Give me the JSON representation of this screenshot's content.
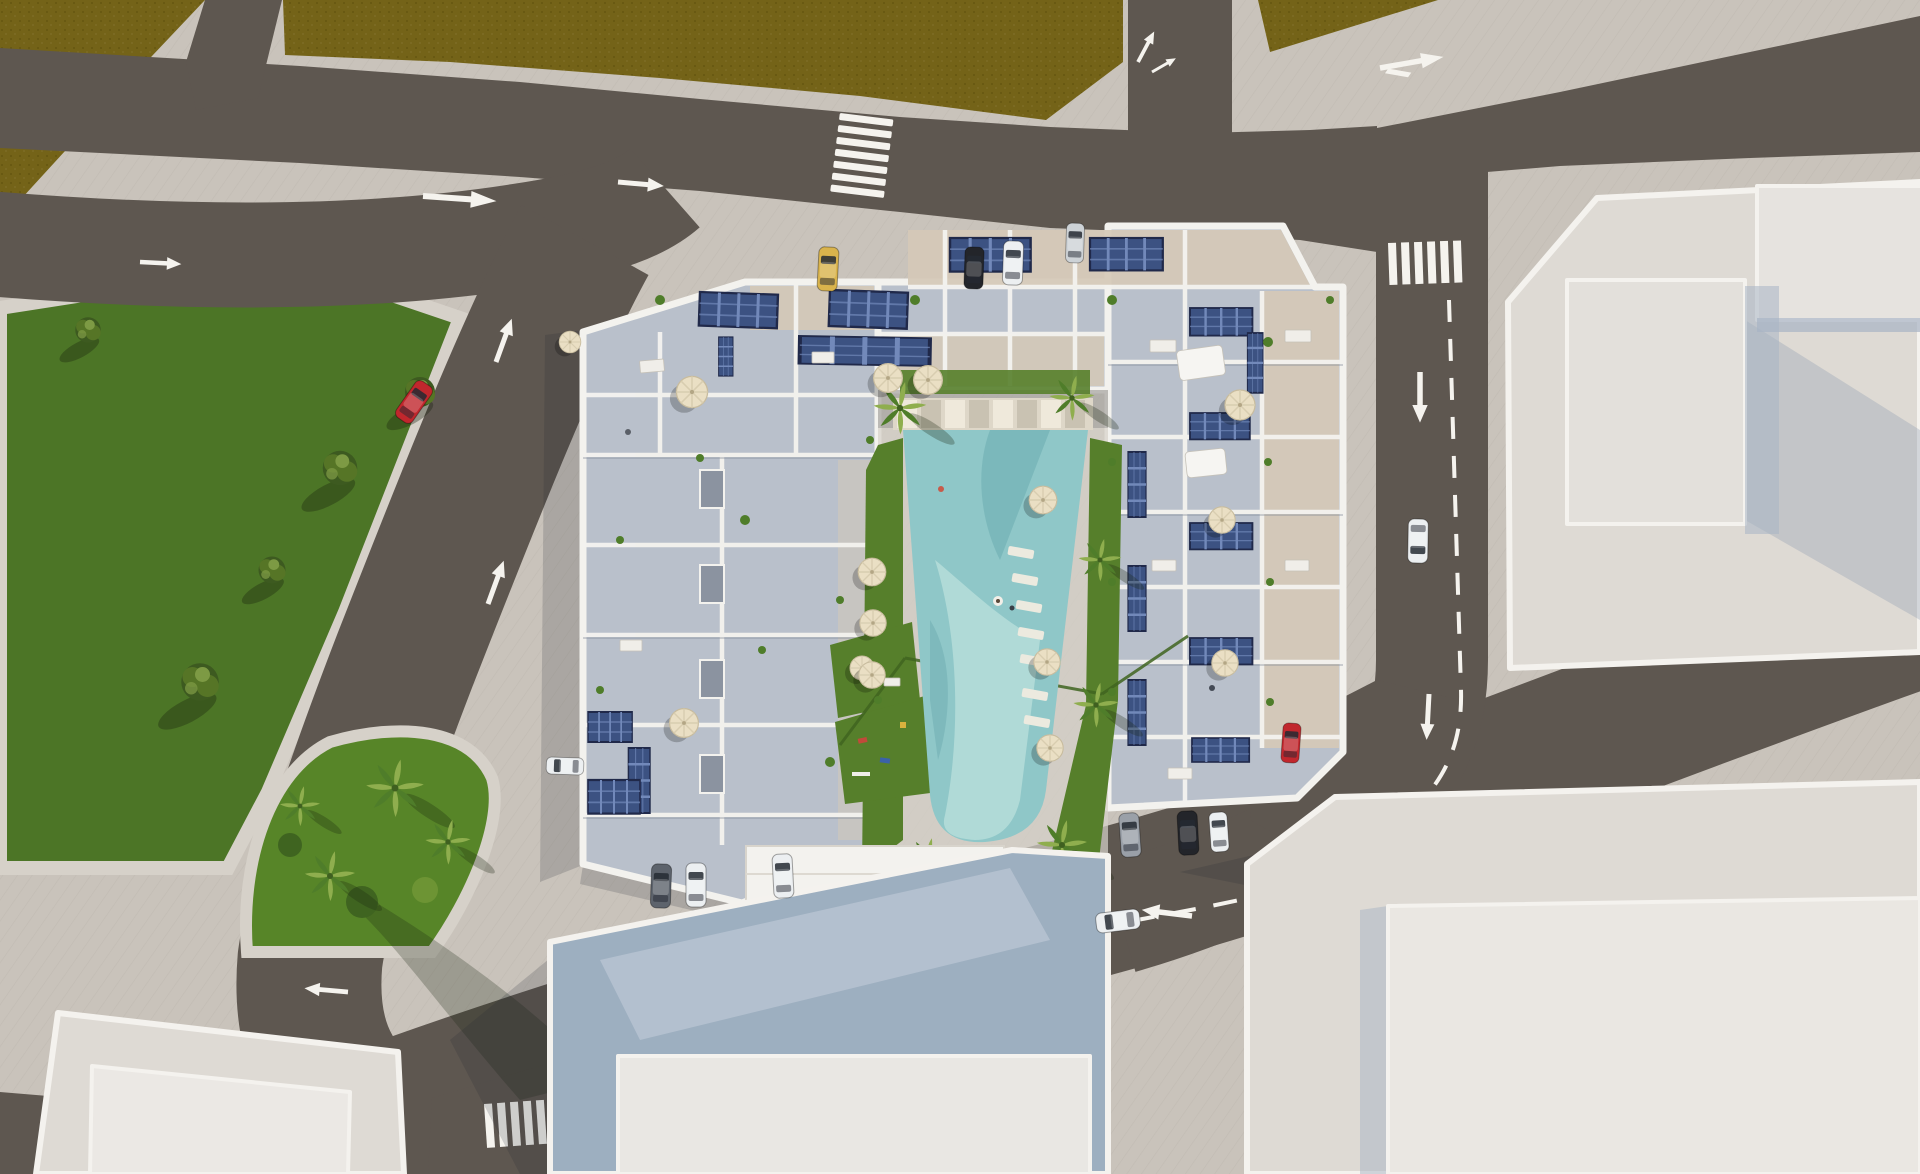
{
  "meta": {
    "title": "Aerial 3D architectural rendering",
    "description": "Top-down bird's-eye 3D render of a white residential apartment complex with rooftop solar panels and terraces around a central courtyard with a turquoise swimming pool, lawns and palm trees; surrounded by asphalt roads with white lane arrows, dashed lines and zebra crossings; olive farmland fields at top-left, a green park with trees on the left, a palm-planted traffic island at bottom-left, and large light-grey warehouse buildings on the right and bottom."
  },
  "palette": {
    "sidewalk": "#c9c3bb",
    "sidewalkLight": "#d6d1c9",
    "field": "#746318",
    "fieldDot": "#64550f",
    "road": "#5e5750",
    "marking": "#f5f3ee",
    "park": "#4c7526",
    "island": "#578528",
    "lawn": "#567f2b",
    "lawnDark": "#3f6420",
    "treeDark": "#3d5a20",
    "treeMid": "#567526",
    "treeLight": "#7d9a44",
    "palm": "#4f7d2a",
    "palmLight": "#8fae4e",
    "wall": "#f3f2ee",
    "floorCool": "#b9c0cb",
    "floorWarm": "#d5c9b7",
    "solar": "#3c5282",
    "solarLine": "#7289ba",
    "umbrella": "#eadfc4",
    "pool": "#8fc7c8",
    "poolLight": "#b8dedb",
    "poolDark": "#64a6ab",
    "coping": "#ded7c8",
    "warehouse": "#dedad4",
    "warehouseTrim": "#f4f2ee",
    "warehouseShade": "#a8b4c4",
    "roofCool": "#9dafc0",
    "carRed": "#c1272d",
    "carYellow": "#d9b34c",
    "carWhite": "#eceff1",
    "carBlack": "#23252a",
    "carGray": "#9aa0a8",
    "carSilver": "#cdd2d6"
  },
  "scene": {
    "environment": {
      "fields": 2,
      "park_trees": 5,
      "island_palms": 4,
      "courtyard_palms": 6,
      "lawns": 5
    },
    "complex": {
      "wings": 3,
      "solar_arrays": 16,
      "umbrellas": 15,
      "swimming_pool": 1,
      "pool_swimmers": 2,
      "pool_shape": "trapezoid, narrows toward south"
    },
    "warehouses": [
      {
        "position": "top-right",
        "raised_roof_sections": 2
      },
      {
        "position": "bottom-right",
        "raised_roof_sections": 1
      },
      {
        "position": "bottom-center",
        "roof": "blue-grey sloped"
      },
      {
        "position": "bottom-left",
        "raised_roof_sections": 1
      }
    ],
    "road_markings": {
      "zebra_crossings": 3,
      "lane_arrows": 12,
      "dashed_center_lines": 2
    },
    "cars": [
      {
        "color": "yellow",
        "area": "north parking row"
      },
      {
        "color": "black",
        "area": "north parking row"
      },
      {
        "color": "white",
        "area": "north parking row"
      },
      {
        "color": "silver",
        "area": "north parking row"
      },
      {
        "color": "red",
        "area": "west road, driving north-east"
      },
      {
        "color": "white",
        "area": "west facade, parked"
      },
      {
        "color": "dark-gray",
        "area": "south parking, left block"
      },
      {
        "color": "white",
        "area": "south parking, left block"
      },
      {
        "color": "white",
        "area": "south parking, left block"
      },
      {
        "color": "gray",
        "area": "south parking, right block"
      },
      {
        "color": "black",
        "area": "south parking, right block"
      },
      {
        "color": "white",
        "area": "south parking, right block"
      },
      {
        "color": "white",
        "area": "south road, driving west"
      },
      {
        "color": "red",
        "area": "south-east junction"
      },
      {
        "color": "white",
        "area": "east road, driving south"
      }
    ]
  }
}
